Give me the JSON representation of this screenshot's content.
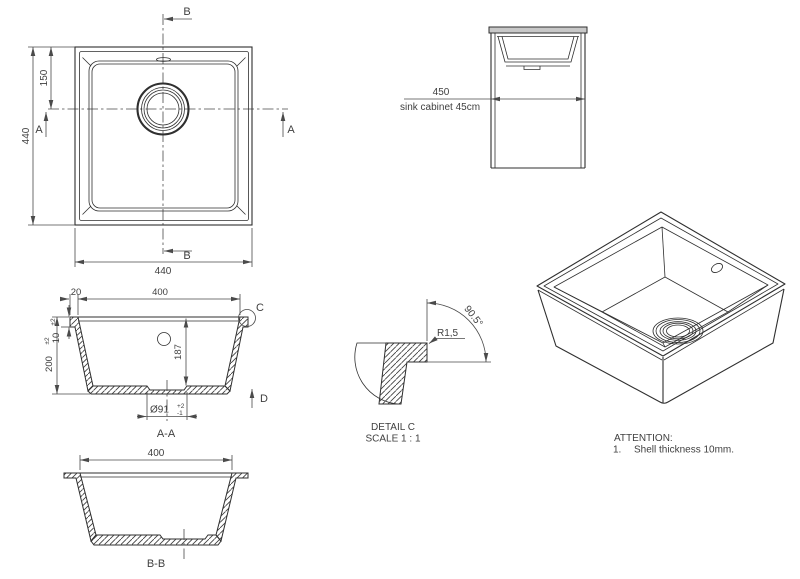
{
  "drawing": {
    "plan": {
      "dim_left": "440",
      "dim_drain_offset": "150",
      "dim_bottom": "440",
      "label_a_left": "A",
      "label_a_right": "A",
      "label_b_top": "B",
      "label_b_bottom": "B"
    },
    "cabinet": {
      "dim_width": "450",
      "caption": "sink cabinet 45cm"
    },
    "section_aa": {
      "title": "A-A",
      "dim_rim": "20",
      "dim_inner_width": "400",
      "dim_depth": "200",
      "dim_depth_tol": "±2",
      "dim_shell": "10",
      "dim_shell_tol": "±2",
      "dim_inner_depth": "187",
      "dim_drain": "Ø91",
      "dim_drain_tol_plus": "+2",
      "dim_drain_tol_minus": "-1",
      "label_c": "C",
      "label_d": "D"
    },
    "detail_c": {
      "title": "DETAIL C",
      "scale": "SCALE 1 : 1",
      "radius": "R1,5",
      "angle": "90.5°"
    },
    "section_bb": {
      "title": "B-B",
      "dim_inner_width": "400"
    },
    "attention": {
      "title": "ATTENTION:",
      "item_number": "1.",
      "item_text": "Shell thickness 10mm."
    },
    "colors": {
      "line": "#2f2f2f",
      "dimension": "#4a4a4a",
      "countertop_fill": "#c8c8c8",
      "background": "#ffffff"
    }
  }
}
